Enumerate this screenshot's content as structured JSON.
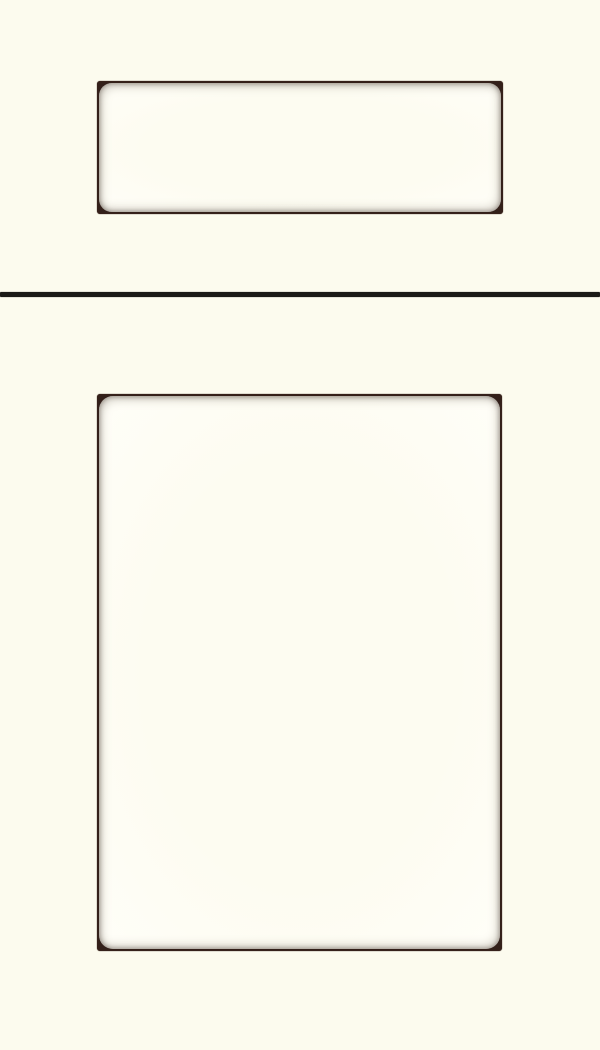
{
  "image": {
    "kind": "cabinet-door-style-sample",
    "components": {
      "drawer_front": {
        "label": "Drawer front"
      },
      "door": {
        "label": "Cabinet door"
      },
      "divider": {
        "label": "Rail divider line"
      }
    }
  },
  "colors": {
    "background": "#fcfbee",
    "panel-face": "#fffef8",
    "panel-center": "#fdfcf1",
    "frame-line": "#33201a",
    "corner-accent": "#3e241c",
    "divider": "#1b1a17"
  }
}
